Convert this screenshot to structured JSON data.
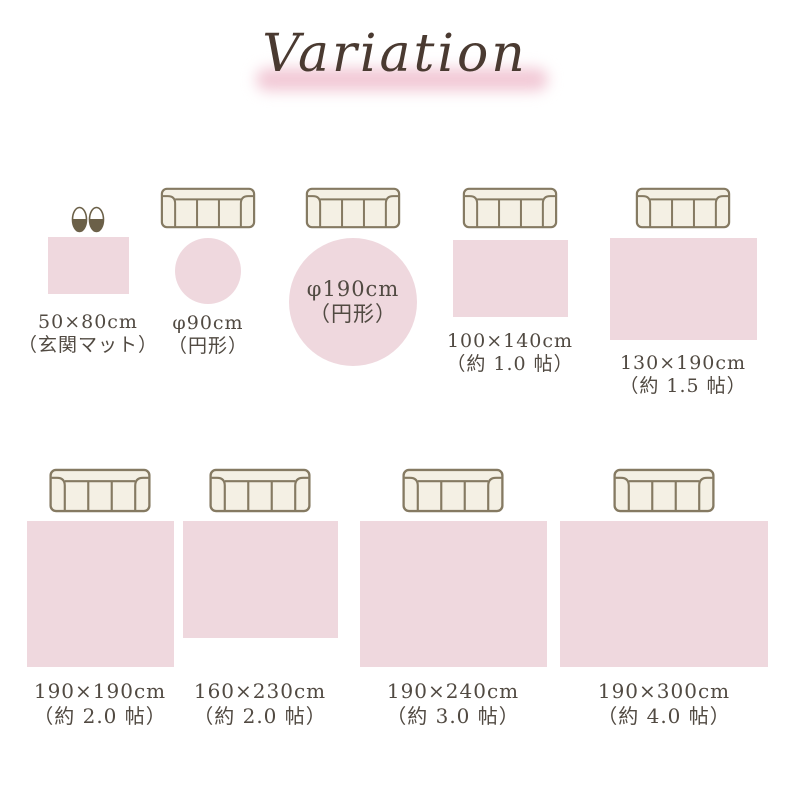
{
  "title": "Variation",
  "colors": {
    "rug_pink": "#efd8de",
    "sofa_fill": "#f4f0e4",
    "sofa_stroke": "#857a62",
    "slipper": "#6b6048",
    "text": "#514a42",
    "title": "#4a3a31",
    "band": "#f2c9d6"
  },
  "items": [
    {
      "size": "50×80cm",
      "note": "（玄関マット）",
      "shape": "rectangle",
      "icon": "slippers"
    },
    {
      "size": "φ90cm",
      "note": "（円形）",
      "shape": "circle",
      "icon": "sofa"
    },
    {
      "size": "φ190cm",
      "note": "（円形）",
      "shape": "circle",
      "icon": "sofa"
    },
    {
      "size": "100×140cm",
      "note": "（約 1.0 帖）",
      "shape": "rectangle",
      "icon": "sofa"
    },
    {
      "size": "130×190cm",
      "note": "（約 1.5 帖）",
      "shape": "rectangle",
      "icon": "sofa"
    },
    {
      "size": "190×190cm",
      "note": "（約 2.0 帖）",
      "shape": "rectangle",
      "icon": "sofa"
    },
    {
      "size": "160×230cm",
      "note": "（約 2.0 帖）",
      "shape": "rectangle",
      "icon": "sofa"
    },
    {
      "size": "190×240cm",
      "note": "（約 3.0 帖）",
      "shape": "rectangle",
      "icon": "sofa"
    },
    {
      "size": "190×300cm",
      "note": "（約 4.0 帖）",
      "shape": "rectangle",
      "icon": "sofa"
    }
  ]
}
